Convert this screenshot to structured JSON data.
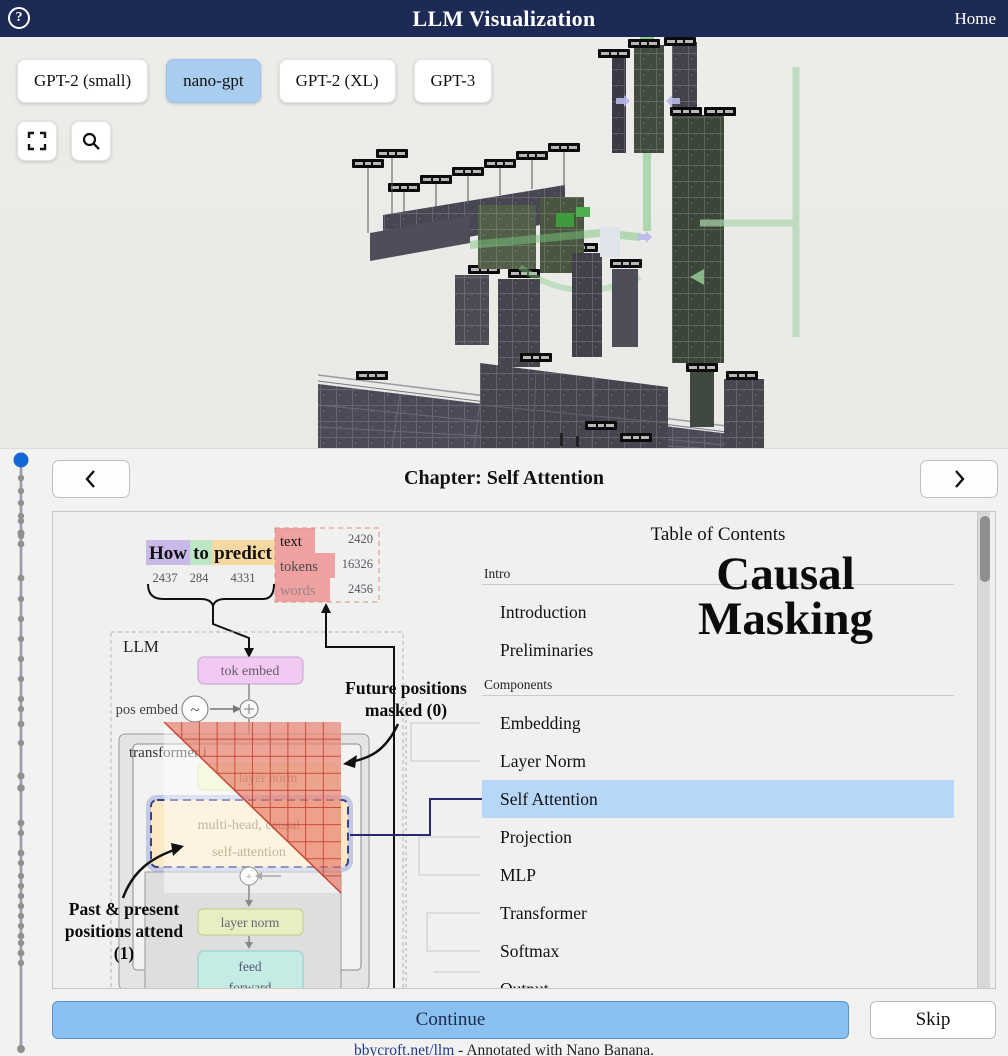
{
  "navbar": {
    "title": "LLM Visualization",
    "home_label": "Home",
    "help_glyph": "?"
  },
  "models": {
    "items": [
      {
        "label": "GPT-2 (small)"
      },
      {
        "label": "nano-gpt"
      },
      {
        "label": "GPT-2 (XL)"
      },
      {
        "label": "GPT-3"
      }
    ],
    "selected": "nano-gpt"
  },
  "icons": {
    "fullscreen": "fullscreen-corners",
    "search": "magnifier",
    "prev": "chevron-left",
    "next": "chevron-right"
  },
  "chapter": {
    "title": "Chapter: Self Attention"
  },
  "diagram": {
    "input_tokens": [
      {
        "word": "How",
        "id": "2437"
      },
      {
        "word": "to",
        "id": "284"
      },
      {
        "word": "predict",
        "id": "4331"
      }
    ],
    "vocab_counts": [
      {
        "label": "text",
        "value": "2420"
      },
      {
        "label": "tokens",
        "value": "16326"
      },
      {
        "label": "words",
        "value": "2456"
      }
    ],
    "llm_label": "LLM",
    "tok_embed_label": "tok embed",
    "pos_embed_label": "pos embed",
    "transformer_label": "transformer i",
    "layer_norm_upper_label": "layer norm",
    "attention_line1": "multi-head, causal",
    "attention_line2": "self-attention",
    "layer_norm_lower_label": "layer norm",
    "feed_forward_line1": "feed",
    "feed_forward_line2": "forward",
    "future_note_line1": "Future positions",
    "future_note_line2": "masked (0)",
    "past_note_line1": "Past & present",
    "past_note_line2": "positions attend",
    "past_note_line3": "(1)"
  },
  "toc": {
    "heading": "Table of Contents",
    "sections": [
      {
        "label": "Intro",
        "items": [
          {
            "label": "Introduction"
          },
          {
            "label": "Preliminaries"
          }
        ]
      },
      {
        "label": "Components",
        "items": [
          {
            "label": "Embedding"
          },
          {
            "label": "Layer Norm"
          },
          {
            "label": "Self Attention"
          },
          {
            "label": "Projection"
          },
          {
            "label": "MLP"
          },
          {
            "label": "Transformer"
          },
          {
            "label": "Softmax"
          },
          {
            "label": "Output"
          }
        ]
      }
    ],
    "active_item": "Self Attention"
  },
  "overlay_title": {
    "line1": "Causal",
    "line2": "Masking"
  },
  "actions": {
    "continue_label": "Continue",
    "skip_label": "Skip"
  },
  "footer": {
    "link_text": "bbycroft.net/llm",
    "credit_text": " - Annotated with Nano Banana."
  },
  "colors": {
    "navbar_bg": "#1d2a55",
    "selected_model_bg": "#a9cdf0",
    "toc_highlight": "#b7d7f9",
    "continue_bg": "#8ac1f1",
    "mask_red": "#e2543e",
    "link_blue": "#223a8f",
    "timeline_marker_blue": "#1566d6"
  }
}
